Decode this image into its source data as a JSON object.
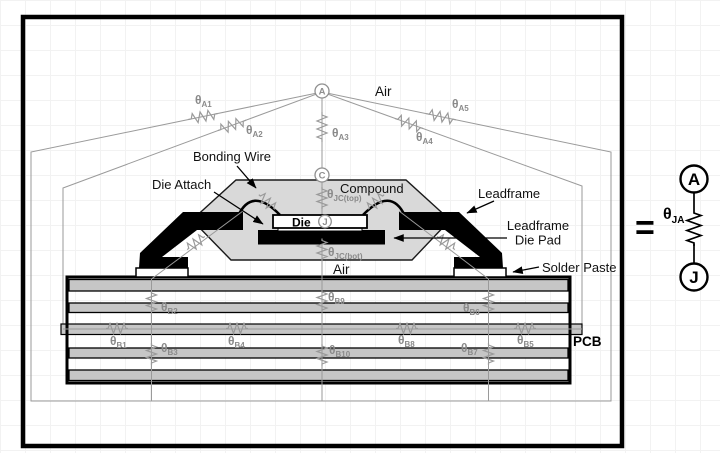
{
  "colors": {
    "network_gray": "#9a9a9a",
    "theta_label_gray": "#8a8a8a",
    "compound_fill": "#d9d9d9",
    "pcb_layer_fill": "#c6c6c6",
    "ink_black": "#000000"
  },
  "figure": {
    "air_top": "Air",
    "air_gap": "Air",
    "pcb": "PCB",
    "component_labels": {
      "bonding_wire": "Bonding Wire",
      "die_attach": "Die Attach",
      "compound": "Compound",
      "die": "Die",
      "leadframe": "Leadframe",
      "leadframe_die_pad_line1": "Leadframe",
      "leadframe_die_pad_line2": "Die Pad",
      "solder_paste": "Solder Paste"
    },
    "nodes": {
      "ambient": "A",
      "case": "C",
      "junction": "J"
    },
    "theta": "θ",
    "resistors": {
      "a1": "A1",
      "a2": "A2",
      "a3": "A3",
      "a4": "A4",
      "a5": "A5",
      "jc_top": "JC(top)",
      "jc_bot": "JC(bot)",
      "b1": "B1",
      "b2": "B2",
      "b3": "B3",
      "b4": "B4",
      "b5": "B5",
      "b6": "B6",
      "b7": "B7",
      "b8": "B8",
      "b9": "B9",
      "b10": "B10"
    }
  },
  "equivalent_circuit": {
    "equals": "=",
    "node_a": "A",
    "node_j": "J",
    "theta": "θ",
    "subscript": "JA"
  }
}
